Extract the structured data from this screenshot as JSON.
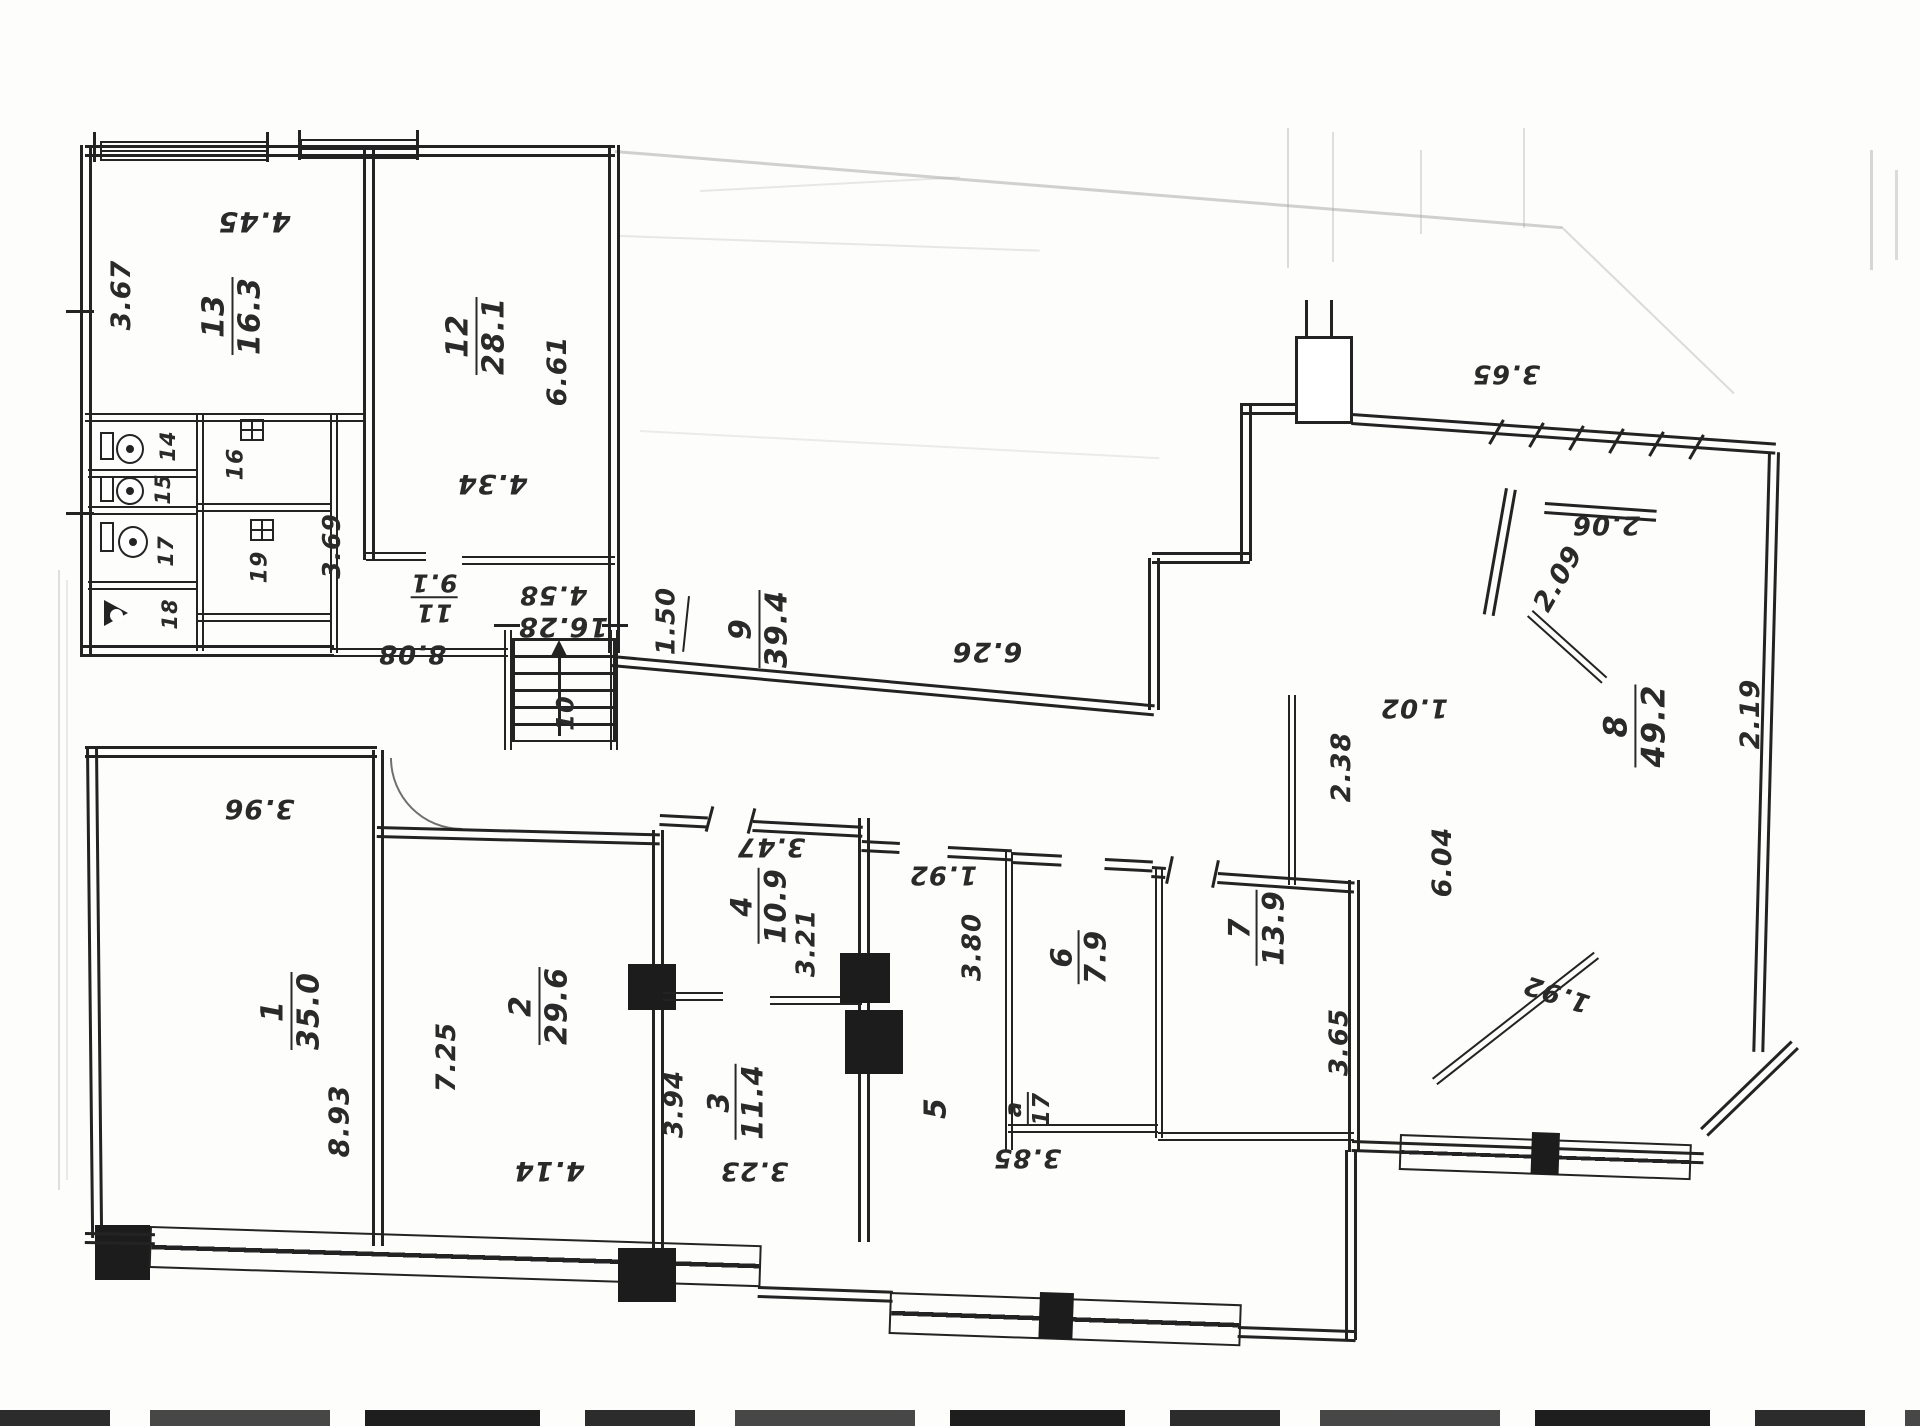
{
  "document": {
    "type": "scanned architectural floor plan (hand-drawn, rotated labels)",
    "area_unit": "m2",
    "dimension_unit": "m",
    "ink_color": "#232323"
  },
  "rooms": [
    {
      "number": "1",
      "area": "35.0",
      "dimensions": [
        "8.93",
        "3.96"
      ]
    },
    {
      "number": "2",
      "area": "29.6",
      "dimensions": [
        "7.25",
        "4.14"
      ]
    },
    {
      "number": "3",
      "area": "11.4",
      "dimensions": [
        "3.94",
        "3.23"
      ]
    },
    {
      "number": "4",
      "area": "10.9",
      "dimensions": [
        "3.47",
        "3.21"
      ]
    },
    {
      "number": "5",
      "area": "",
      "dimensions": []
    },
    {
      "number": "6",
      "area": "7.9",
      "dimensions": [
        "3.80",
        "1.92",
        "3.85"
      ]
    },
    {
      "number": "7",
      "area": "13.9",
      "dimensions": [
        "3.65",
        "3.85"
      ]
    },
    {
      "number": "8",
      "area": "49.2",
      "dimensions": [
        "2.09",
        "2.06",
        "3.65",
        "2.19",
        "6.04",
        "2.38",
        "1.02",
        "1.92"
      ]
    },
    {
      "number": "9",
      "area": "39.4",
      "dimensions": [
        "1.50",
        "16.28",
        "8.08",
        "6.26"
      ]
    },
    {
      "number": "10",
      "area": "",
      "dimensions": [],
      "note": "staircase"
    },
    {
      "number": "11",
      "area": "9.1",
      "dimensions": [
        "4.58",
        "3.69"
      ]
    },
    {
      "number": "12",
      "area": "28.1",
      "dimensions": [
        "6.61",
        "4.34"
      ]
    },
    {
      "number": "13",
      "area": "16.3",
      "dimensions": [
        "3.67",
        "4.45"
      ]
    },
    {
      "number": "14",
      "area": ""
    },
    {
      "number": "15",
      "area": ""
    },
    {
      "number": "16",
      "area": ""
    },
    {
      "number": "17",
      "area": ""
    },
    {
      "number": "18",
      "area": ""
    },
    {
      "number": "19",
      "area": ""
    },
    {
      "number": "а/17",
      "area": "",
      "note": "annex annotation near room 5"
    }
  ],
  "labels": [
    {
      "name": "room-label-13",
      "num": "13",
      "den": "16.3",
      "x": 232,
      "y": 316,
      "rot": -90,
      "size": 30
    },
    {
      "name": "dim-3-67",
      "text": "3.67",
      "x": 122,
      "y": 295,
      "rot": -90,
      "size": 27
    },
    {
      "name": "dim-4-45",
      "text": "4.45",
      "x": 254,
      "y": 222,
      "rot": 180,
      "size": 28
    },
    {
      "name": "room-label-12",
      "num": "12",
      "den": "28.1",
      "x": 476,
      "y": 336,
      "rot": -90,
      "size": 30
    },
    {
      "name": "dim-6-61",
      "text": "6.61",
      "x": 558,
      "y": 371,
      "rot": -90,
      "size": 27
    },
    {
      "name": "dim-4-34",
      "text": "4.34",
      "x": 492,
      "y": 483,
      "rot": 180,
      "size": 27
    },
    {
      "name": "dim-3-69",
      "text": "3.69",
      "x": 332,
      "y": 546,
      "rot": -90,
      "size": 25
    },
    {
      "name": "room-label-14",
      "text": "14",
      "x": 168,
      "y": 446,
      "rot": -90,
      "size": 21
    },
    {
      "name": "room-label-15",
      "text": "15",
      "x": 163,
      "y": 489,
      "rot": -90,
      "size": 21
    },
    {
      "name": "room-label-16",
      "text": "16",
      "x": 236,
      "y": 464,
      "rot": -90,
      "size": 22
    },
    {
      "name": "room-label-17",
      "text": "17",
      "x": 166,
      "y": 551,
      "rot": -90,
      "size": 21
    },
    {
      "name": "room-label-19",
      "text": "19",
      "x": 260,
      "y": 567,
      "rot": -90,
      "size": 22
    },
    {
      "name": "room-label-18",
      "text": "18",
      "x": 170,
      "y": 614,
      "rot": -90,
      "size": 21
    },
    {
      "name": "room-label-11",
      "num": "11",
      "den": "9.1",
      "x": 434,
      "y": 597,
      "rot": 180,
      "size": 25
    },
    {
      "name": "dim-4-58",
      "text": "4.58",
      "x": 553,
      "y": 594,
      "rot": 180,
      "size": 26
    },
    {
      "name": "stairs-label-10",
      "text": "10",
      "x": 566,
      "y": 713,
      "rot": -90,
      "size": 24
    },
    {
      "name": "dim-16-28",
      "text": "16.28",
      "x": 563,
      "y": 626,
      "rot": 180,
      "size": 27
    },
    {
      "name": "dim-1-50",
      "text": "1.50",
      "x": 667,
      "y": 621,
      "rot": -90,
      "size": 26
    },
    {
      "name": "room-label-9",
      "num": "9",
      "den": "39.4",
      "x": 759,
      "y": 629,
      "rot": -90,
      "size": 30
    },
    {
      "name": "dim-8-08",
      "text": "8.08",
      "x": 412,
      "y": 653,
      "rot": 180,
      "size": 26
    },
    {
      "name": "dim-3-96",
      "text": "3.96",
      "x": 259,
      "y": 808,
      "rot": 180,
      "size": 27
    },
    {
      "name": "room-label-1",
      "num": "1",
      "den": "35.0",
      "x": 291,
      "y": 1011,
      "rot": -90,
      "size": 30
    },
    {
      "name": "dim-8-93",
      "text": "8.93",
      "x": 339,
      "y": 1121,
      "rot": -90,
      "size": 28
    },
    {
      "name": "room-label-2",
      "num": "2",
      "den": "29.6",
      "x": 539,
      "y": 1006,
      "rot": -90,
      "size": 30
    },
    {
      "name": "dim-7-25",
      "text": "7.25",
      "x": 447,
      "y": 1057,
      "rot": -90,
      "size": 27
    },
    {
      "name": "dim-4-14",
      "text": "4.14",
      "x": 549,
      "y": 1170,
      "rot": 180,
      "size": 27
    },
    {
      "name": "room-label-4",
      "num": "4",
      "den": "10.9",
      "x": 759,
      "y": 906,
      "rot": -90,
      "size": 29
    },
    {
      "name": "dim-3-47",
      "text": "3.47",
      "x": 771,
      "y": 846,
      "rot": 180,
      "size": 26
    },
    {
      "name": "dim-3-21",
      "text": "3.21",
      "x": 807,
      "y": 943,
      "rot": -90,
      "size": 26
    },
    {
      "name": "room-label-3",
      "num": "3",
      "den": "11.4",
      "x": 736,
      "y": 1102,
      "rot": -90,
      "size": 29
    },
    {
      "name": "dim-3-94",
      "text": "3.94",
      "x": 675,
      "y": 1104,
      "rot": -90,
      "size": 26
    },
    {
      "name": "dim-3-23",
      "text": "3.23",
      "x": 754,
      "y": 1170,
      "rot": 180,
      "size": 26
    },
    {
      "name": "room-label-5",
      "text": "5",
      "x": 936,
      "y": 1108,
      "rot": -90,
      "size": 30
    },
    {
      "name": "room-label-a-17",
      "num": "а",
      "den": "17",
      "x": 1028,
      "y": 1109,
      "rot": -90,
      "size": 23
    },
    {
      "name": "dim-1-92-rooms",
      "text": "1.92",
      "x": 943,
      "y": 874,
      "rot": 180,
      "size": 26
    },
    {
      "name": "dim-3-80",
      "text": "3.80",
      "x": 973,
      "y": 947,
      "rot": -90,
      "size": 26
    },
    {
      "name": "room-label-6",
      "num": "6",
      "den": "7.9",
      "x": 1079,
      "y": 957,
      "rot": -90,
      "size": 29
    },
    {
      "name": "dim-3-85",
      "text": "3.85",
      "x": 1027,
      "y": 1157,
      "rot": 180,
      "size": 26
    },
    {
      "name": "room-label-7",
      "num": "7",
      "den": "13.9",
      "x": 1257,
      "y": 928,
      "rot": -90,
      "size": 29
    },
    {
      "name": "dim-3-65-room7",
      "text": "3.65",
      "x": 1340,
      "y": 1042,
      "rot": -90,
      "size": 26
    },
    {
      "name": "dim-6-26",
      "text": "6.26",
      "x": 987,
      "y": 651,
      "rot": 180,
      "size": 27
    },
    {
      "name": "dim-2-38",
      "text": "2.38",
      "x": 1342,
      "y": 767,
      "rot": -90,
      "size": 27
    },
    {
      "name": "dim-1-02",
      "text": "1.02",
      "x": 1414,
      "y": 707,
      "rot": 180,
      "size": 26
    },
    {
      "name": "dim-6-04",
      "text": "6.04",
      "x": 1443,
      "y": 862,
      "rot": -90,
      "size": 27
    },
    {
      "name": "room-label-8",
      "num": "8",
      "den": "49.2",
      "x": 1635,
      "y": 726,
      "rot": -90,
      "size": 32
    },
    {
      "name": "dim-2-19",
      "text": "2.19",
      "x": 1751,
      "y": 714,
      "rot": -90,
      "size": 27
    },
    {
      "name": "dim-2-09",
      "text": "2.09",
      "x": 1559,
      "y": 579,
      "rot": -60,
      "size": 27
    },
    {
      "name": "dim-2-06",
      "text": "2.06",
      "x": 1606,
      "y": 524,
      "rot": 180,
      "size": 26
    },
    {
      "name": "dim-3-65-top",
      "text": "3.65",
      "x": 1506,
      "y": 373,
      "rot": 180,
      "size": 26
    },
    {
      "name": "dim-1-92-wing",
      "text": "1.92",
      "x": 1557,
      "y": 993,
      "rot": 198,
      "size": 26
    }
  ]
}
